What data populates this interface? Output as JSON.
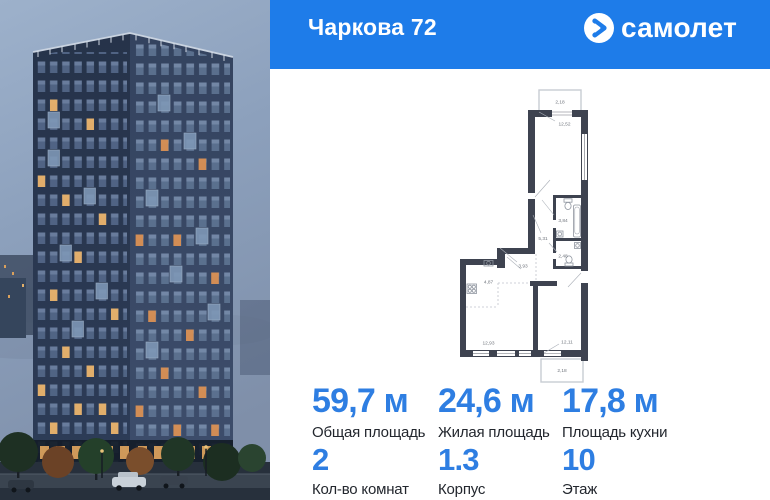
{
  "header": {
    "title": "Чаркова 72",
    "brand_name": "самолет"
  },
  "floor_plan": {
    "rooms": [
      {
        "name": "balcony-top",
        "area": "2,18"
      },
      {
        "name": "bedroom",
        "area": "12,52"
      },
      {
        "name": "bathroom",
        "area": "3,84"
      },
      {
        "name": "hallway",
        "area": "5,31"
      },
      {
        "name": "wc",
        "area": "2,48"
      },
      {
        "name": "corridor",
        "area": "3,93"
      },
      {
        "name": "kitchen-zone",
        "area": "4,87"
      },
      {
        "name": "living-room",
        "area": "12,93"
      },
      {
        "name": "room",
        "area": "12,11"
      },
      {
        "name": "balcony-bottom",
        "area": "2,18"
      }
    ]
  },
  "stats": {
    "areas": [
      {
        "value": "59,7 м",
        "label": "Общая площадь"
      },
      {
        "value": "24,6 м",
        "label": "Жилая площадь"
      },
      {
        "value": "17,8 м",
        "label": "Площадь кухни"
      }
    ],
    "details": [
      {
        "value": "2",
        "label": "Кол-во комнат"
      },
      {
        "value": "1.3",
        "label": "Корпус"
      },
      {
        "value": "10",
        "label": "Этаж"
      }
    ]
  },
  "colors": {
    "brand_blue": "#1E7CE9",
    "value_blue": "#2E7EE2",
    "plan_wall": "#3E4350"
  }
}
